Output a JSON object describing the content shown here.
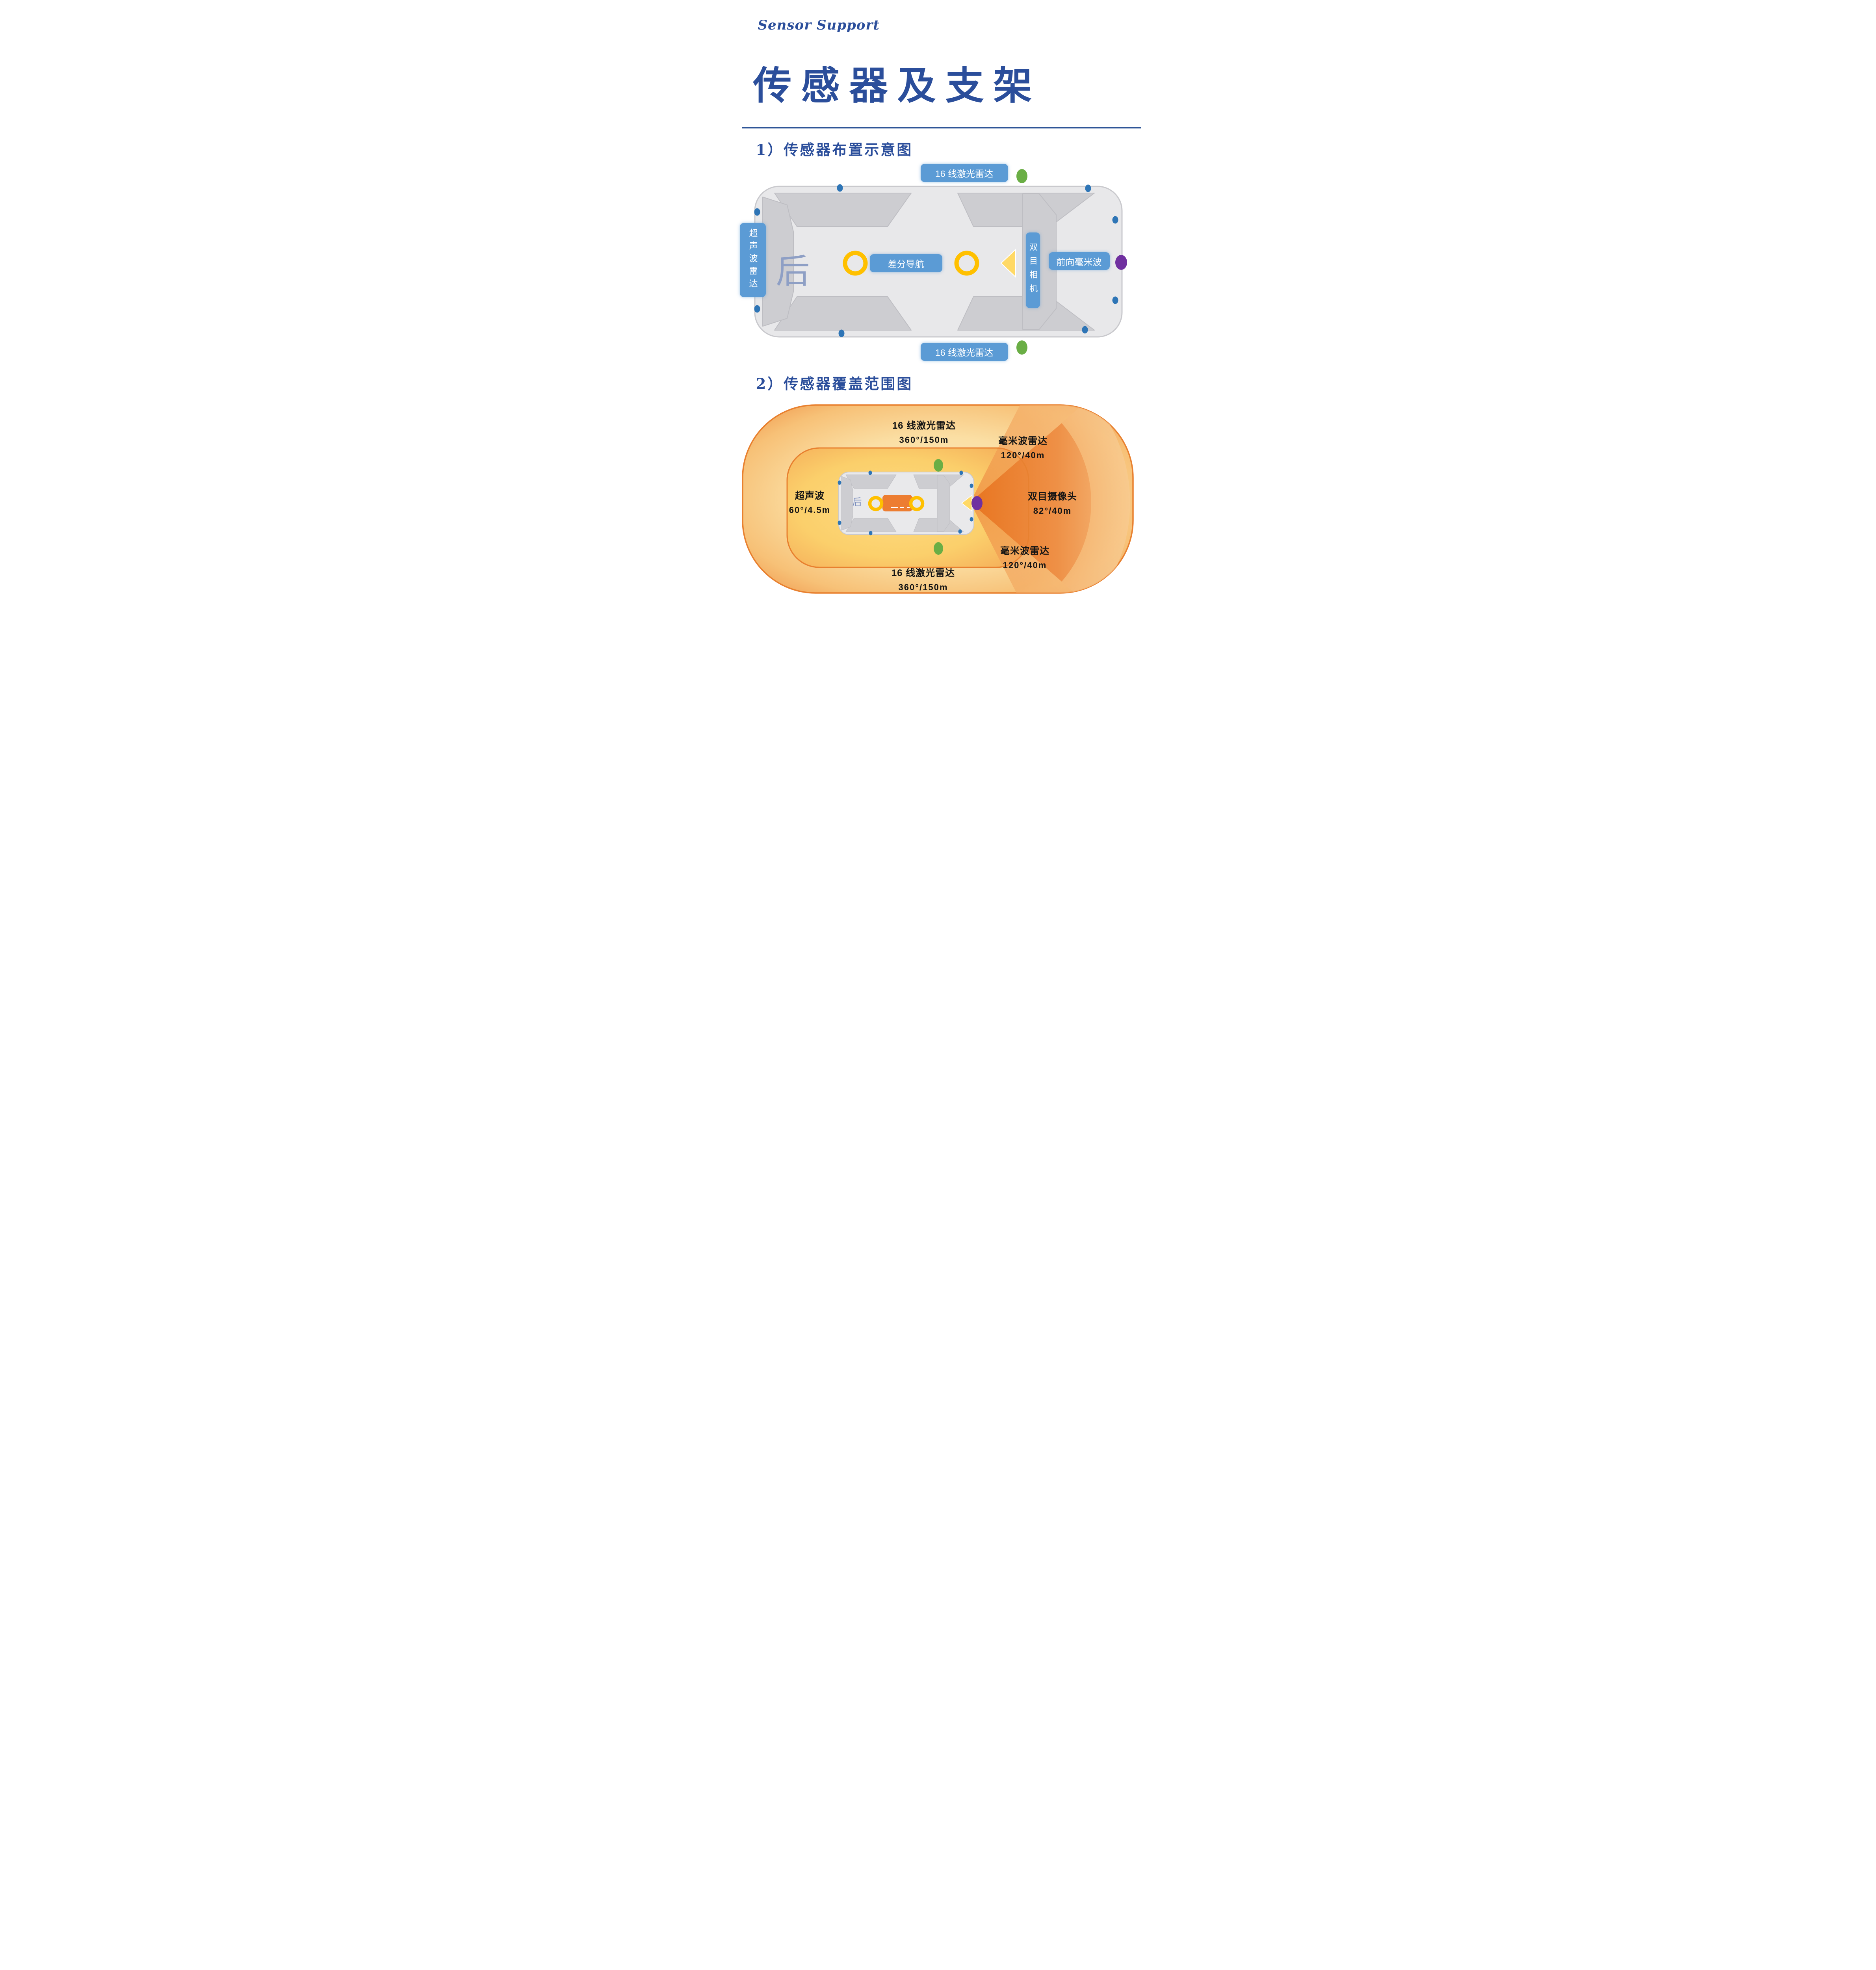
{
  "page": {
    "logo": "Sensor Support",
    "title": "传感器及支架",
    "section1": "1）传感器布置示意图",
    "section2": "2）传感器覆盖范围图"
  },
  "colors": {
    "brand_blue": "#2B4F9B",
    "divider_blue": "#2E5597",
    "label_blue": "#5B9BD5",
    "ultrasonic_dot_blue": "#2E75B6",
    "lidar_green": "#6AAE45",
    "radar_purple": "#7030A0",
    "gnss_ring_yellow": "#FFC000",
    "camera_triangle_yellow": "#FFD966",
    "coverage_border_orange": "#E8802F",
    "fov_orange": "#ED7D31",
    "car_body_gray": "#E8E8EA",
    "cabin_gray": "#CDCDD1",
    "rear_text_blue": "#8E9FC5"
  },
  "fig1": {
    "lidar_top": "16 线激光雷达",
    "lidar_bottom": "16 线激光雷达",
    "ultrasonic": "超声波雷达",
    "rear": "后",
    "diff_nav": "差分导航",
    "stereo_camera": "双目相机",
    "front_mmw": "前向毫米波"
  },
  "fig2": {
    "rear": "后",
    "lidar_top": {
      "name": "16 线激光雷达",
      "spec": "360°/150m"
    },
    "mmw_top": {
      "name": "毫米波雷达",
      "spec": "120°/40m"
    },
    "ultrasonic": {
      "name": "超声波",
      "spec": "60°/4.5m"
    },
    "stereo": {
      "name": "双目摄像头",
      "spec": "82°/40m"
    },
    "mmw_bottom": {
      "name": "毫米波雷达",
      "spec": "120°/40m"
    },
    "lidar_bottom": {
      "name": "16 线激光雷达",
      "spec": "360°/150m"
    }
  },
  "markers": {
    "lidar_marker": "#6AAE45",
    "ultrasonic_marker": "#2E75B6",
    "mmw_radar_marker": "#7030A0",
    "gnss_antenna_ring": "#FFC000",
    "camera_fov_arrow": "#FFD966"
  }
}
